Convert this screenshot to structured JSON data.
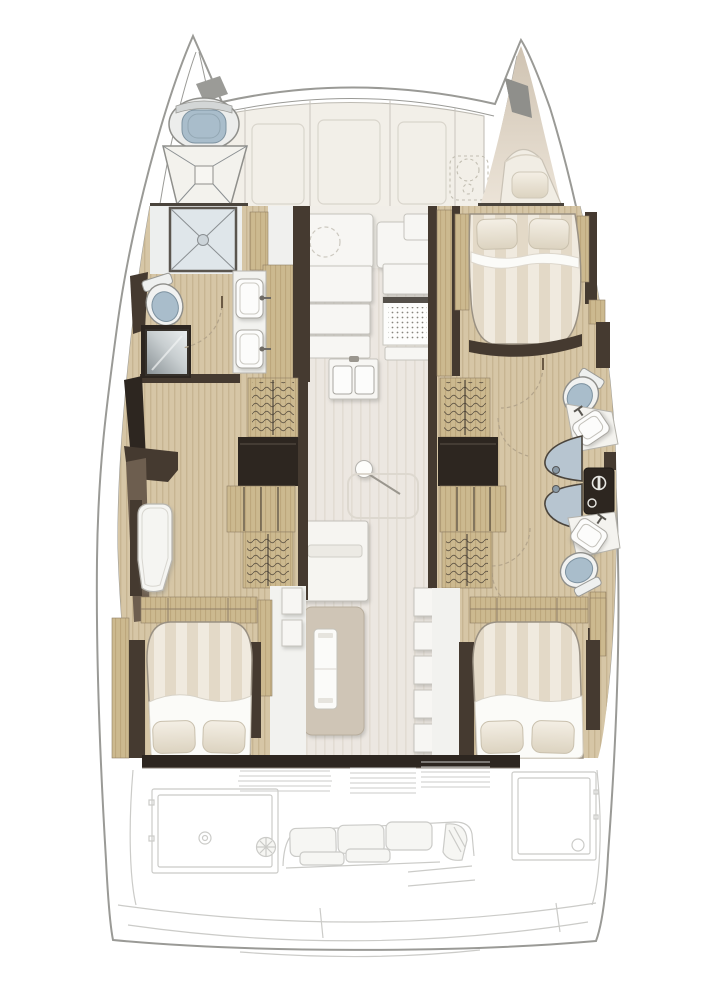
{
  "image": {
    "width": 710,
    "height": 994,
    "background": "#ffffff"
  },
  "palette": {
    "hullOutline": "#9a9a96",
    "deckCream": "#f2efe8",
    "woodFloor": "#d6c6a6",
    "woodStripe": "#c7b592",
    "cabinetWood": "#ccb98f",
    "cabinetStripe": "#bda77c",
    "darkWall": "#453a30",
    "darkWall2": "#2d2620",
    "midWall": "#6d5e4f",
    "salonFloor": "#ece7e1",
    "salonStripe": "#e2dcd3",
    "bedDuvet": "#f0eadf",
    "bedStripe": "#e3d9c7",
    "bedSheet": "#fbfbf8",
    "pillowLight": "#f2ede3",
    "pillowDark": "#ddd4c1",
    "toiletSeat": "#a9bdcb",
    "showerGlass": "#b7c5d0",
    "showerTray": "#dfe6ea",
    "fixtureWhite": "#f7f6f3",
    "ghostLine": "#cbcbc8",
    "ghostFill": "#f6f6f3",
    "metalDark": "#57524b"
  },
  "inventory": {
    "double_bed_cabins": 3,
    "bow_berths": 1,
    "toilets": 4,
    "shower_enclosures": 3,
    "washbasins": 4,
    "galley_sink_basins": 2,
    "stoves": 1,
    "wardrobes": 4,
    "shelf_units": 2,
    "dining_tables": 1,
    "mast_posts": 1,
    "cockpit_bench_cushions": 3,
    "winches": 1
  }
}
